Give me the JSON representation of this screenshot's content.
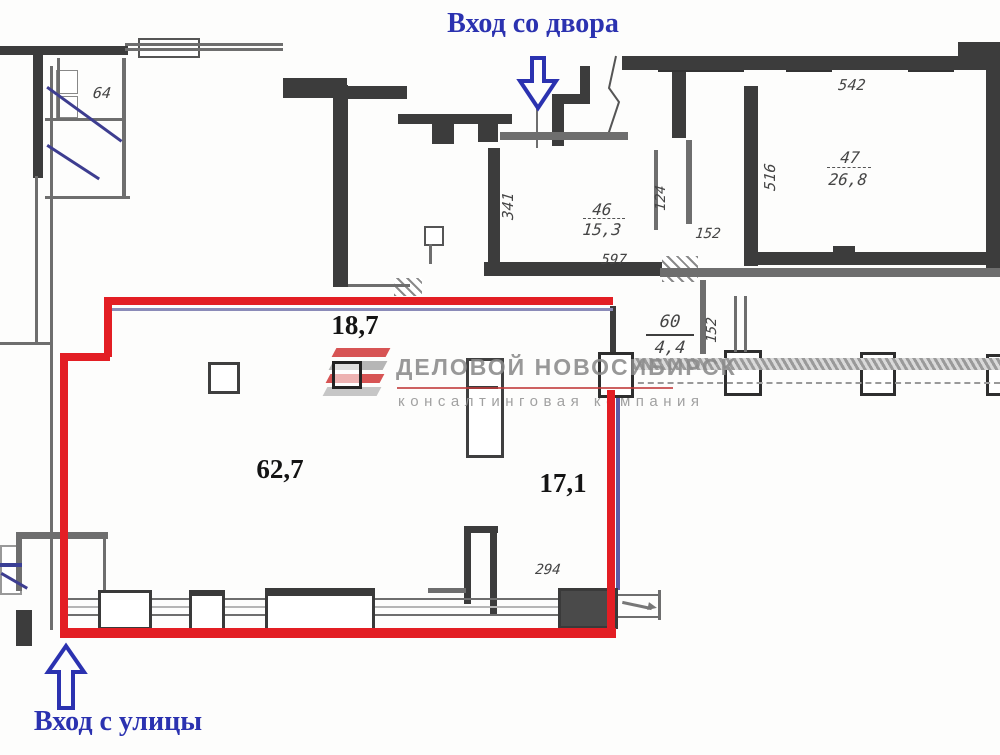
{
  "annotations": {
    "courtyard_entrance": "Вход со двора",
    "street_entrance": "Вход с улицы"
  },
  "highlighted_zone": {
    "top_strip_area": "18,7",
    "hall_area": "62,7",
    "right_strip_area": "17,1"
  },
  "rooms": [
    {
      "number": "46",
      "area": "15,3"
    },
    {
      "number": "47",
      "area": "26,8"
    },
    {
      "number": "60",
      "area": "4,4"
    }
  ],
  "dimensions": {
    "stair_64": "64",
    "vestibule_341": "341",
    "corridor_597": "597",
    "passage_124": "124",
    "passage_152": "152",
    "room47_542": "542",
    "room47_516": "516",
    "corridor_152": "152",
    "window_294": "294"
  },
  "watermark": {
    "company": "ДЕЛОВОЙ НОВОСИБИРСК",
    "tagline": "консалтинговая компания"
  },
  "colors": {
    "highlight_red": "#e31e24",
    "annotation_blue": "#2b32b0",
    "watermark_gray": "#9a9a9a",
    "watermark_red": "#c03a3a"
  }
}
